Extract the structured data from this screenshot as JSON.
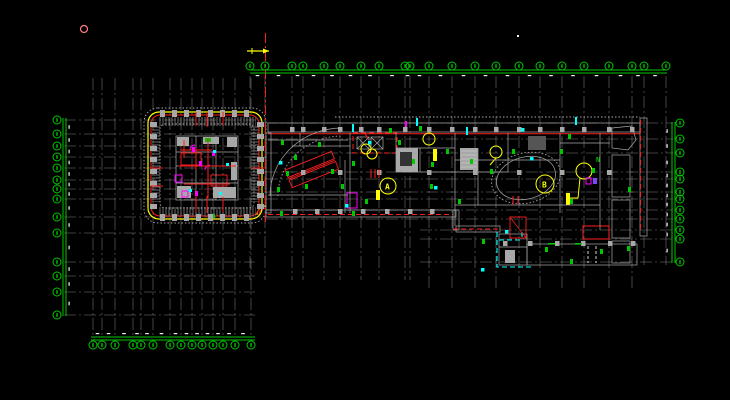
{
  "drawing": {
    "balloon_label_a": "A",
    "balloon_label_b": "B",
    "room_label_n": "N"
  },
  "colors": {
    "background": "#000000",
    "grid_line": "#9c9c9c",
    "dimension_green": "#00c800",
    "outline_red": "#ff1e1e",
    "accent_yellow": "#ffff00",
    "wall_gray": "#a8a8a8",
    "wall_gray_dark": "#4a4a4a",
    "magenta": "#ff00ff",
    "cyan": "#00ffff",
    "white": "#ffffff",
    "pink_marker": "#ff8080"
  },
  "icons": {
    "grid_bubble": "circle-with-number",
    "section_arrow": "arrow-right",
    "reference_circle": "small-circle"
  }
}
